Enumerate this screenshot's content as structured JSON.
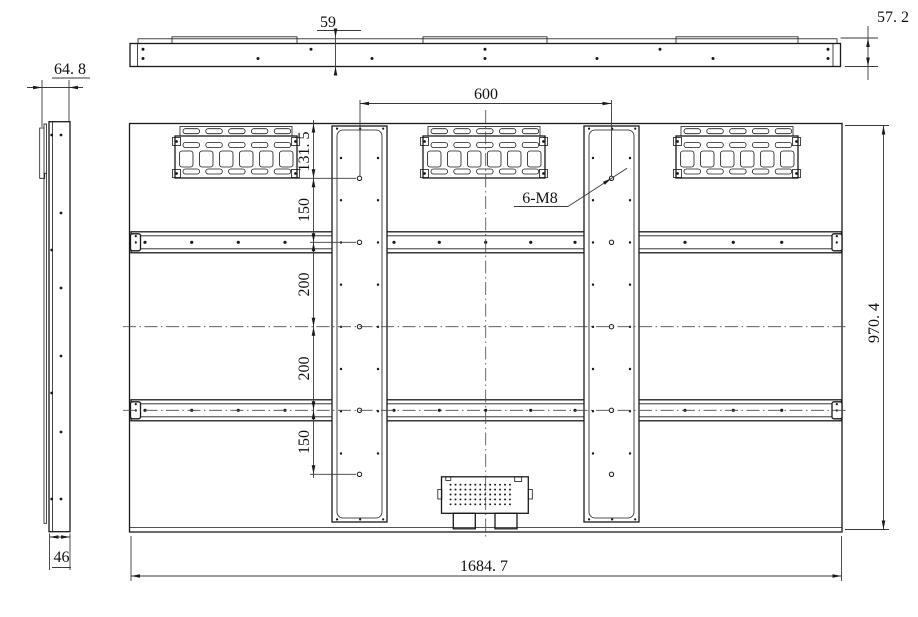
{
  "drawing": {
    "type": "engineering-drawing",
    "subject": "large display panel rear / top / side views with VESA mounting dimensions",
    "colors": {
      "background": "#ffffff",
      "object_line": "#1a1a1a",
      "dimension_line": "#3a3a3a",
      "centerline": "#4a4a4a"
    },
    "views": {
      "top": "top-view",
      "side": "side-view",
      "rear": "rear-view"
    },
    "dimensions": {
      "top_plate_offset": "59",
      "top_view_thickness": "57. 2",
      "side_view_depth": "64. 8",
      "side_view_width": "46",
      "vesa_horizontal": "600",
      "top_to_first_hole": "131. 5",
      "hole_pitch_a": "150",
      "hole_pitch_b": "200",
      "hole_pitch_c": "200",
      "hole_pitch_d": "150",
      "panel_height": "970. 4",
      "panel_width": "1684. 7",
      "thread_callout": "6-M8"
    }
  }
}
